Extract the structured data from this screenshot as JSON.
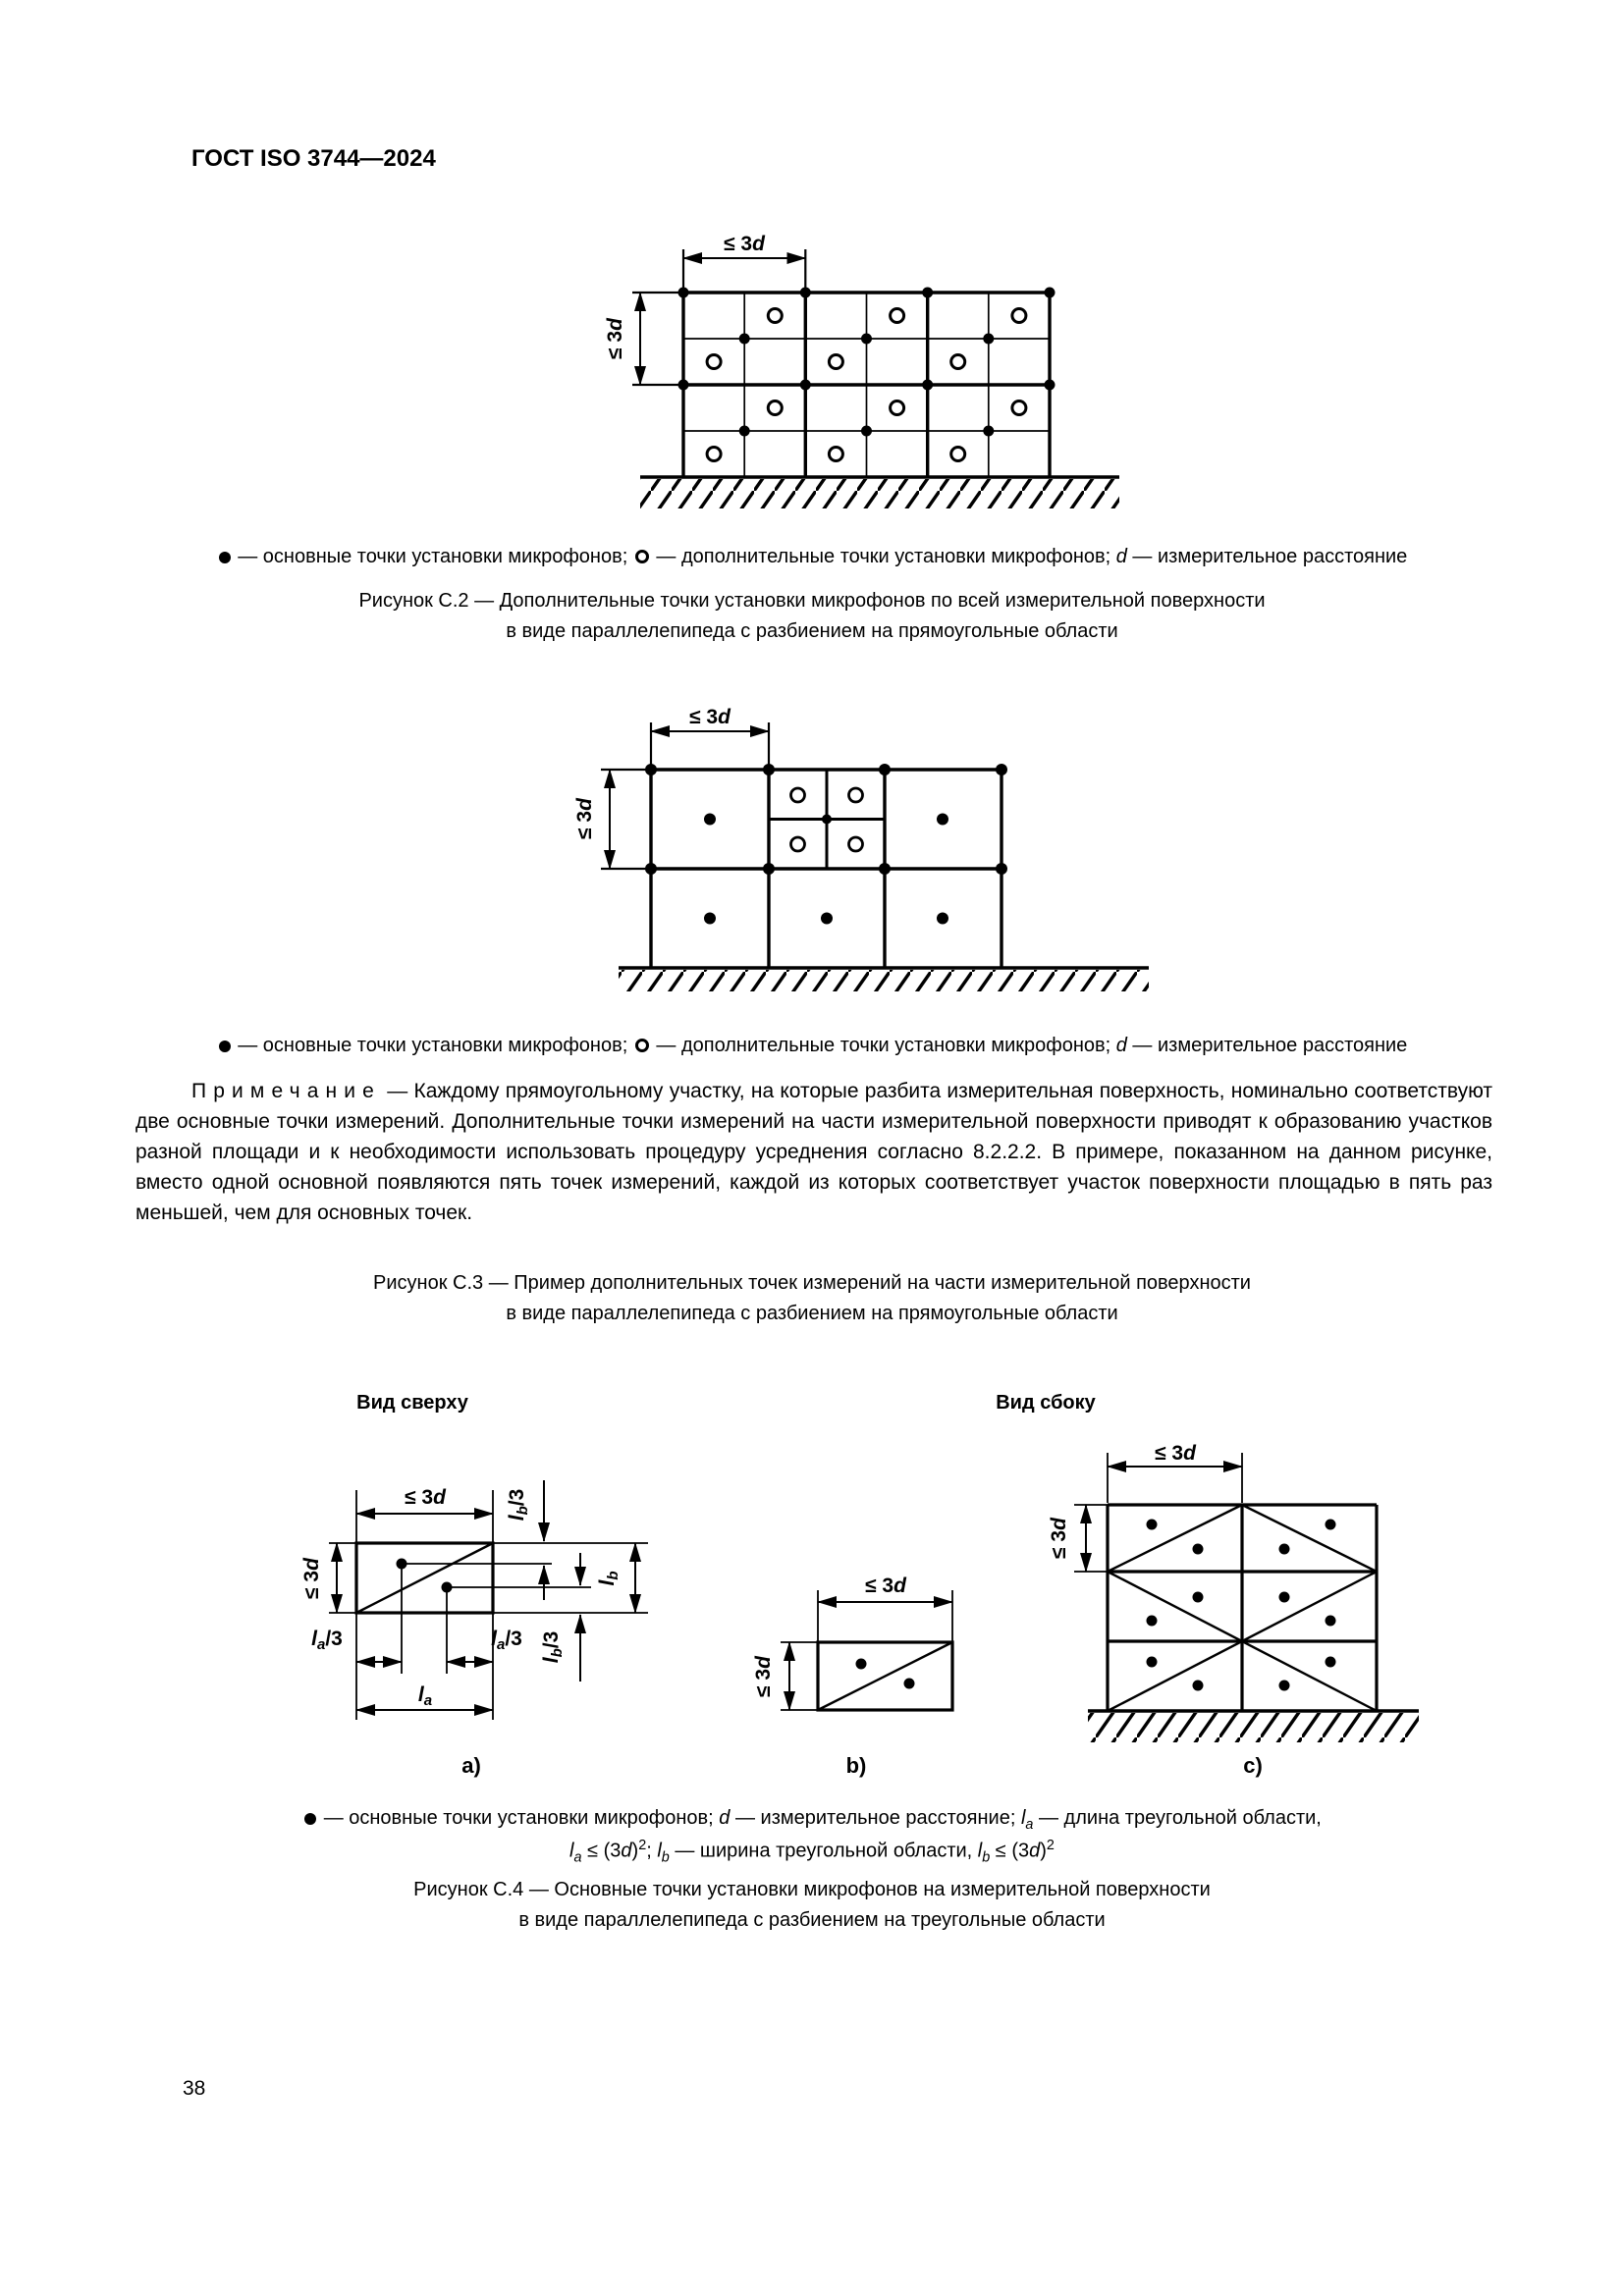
{
  "page": {
    "header": "ГОСТ ISO 3744—2024",
    "number": "38"
  },
  "sym": {
    "main_point": "●",
    "additional_point": "○",
    "le3": "≤ 3",
    "d": "d",
    "l": "l",
    "a": "a",
    "b": "b",
    "slash3": "/3",
    "two": "2",
    "le_paren": " ≤ (3",
    "rparen": ")",
    "semicolon": "; "
  },
  "legend_points": {
    "main": " — основные точки установки микрофонов; ",
    "additional": " — дополнительные точки установки микрофонов; ",
    "distance": " — измерительное расстояние"
  },
  "note": {
    "label": "Примечание",
    "text": "— Каждому прямоугольному участку, на которые разбита измерительная поверхность, номинально соответствуют две основные точки измерений. Дополнительные точки измерений на части измерительной поверхности приводят к образованию участков разной площади и к необходимости использовать процедуру усреднения согласно 8.2.2.2. В примере, показанном на данном рисунке, вместо одной основной появляются пять точек измерений, каждой из которых соответствует участок поверхности площадью в пять раз меньшей, чем для основных точек."
  },
  "fig_c2": {
    "caption1": "Рисунок С.2 — Дополнительные точки установки микрофонов по всей измерительной поверхности",
    "caption2": "в виде параллелепипеда с разбиением на прямоугольные области"
  },
  "fig_c3": {
    "caption1": "Рисунок С.3 — Пример дополнительных точек измерений на части измерительной поверхности",
    "caption2": "в виде параллелепипеда с разбиением на прямоугольные области"
  },
  "fig_c4": {
    "view_top": "Вид сверху",
    "view_side": "Вид сбоку",
    "sub_a": "a)",
    "sub_b": "b)",
    "sub_c": "c)",
    "legend1_distance": " — измерительное расстояние; ",
    "legend1_length": " — длина треугольной области,",
    "legend2_width": " — ширина треугольной области, ",
    "caption1": "Рисунок С.4 — Основные точки установки микрофонов на измерительной поверхности",
    "caption2": "в виде параллелепипеда с разбиением на треугольные области"
  }
}
